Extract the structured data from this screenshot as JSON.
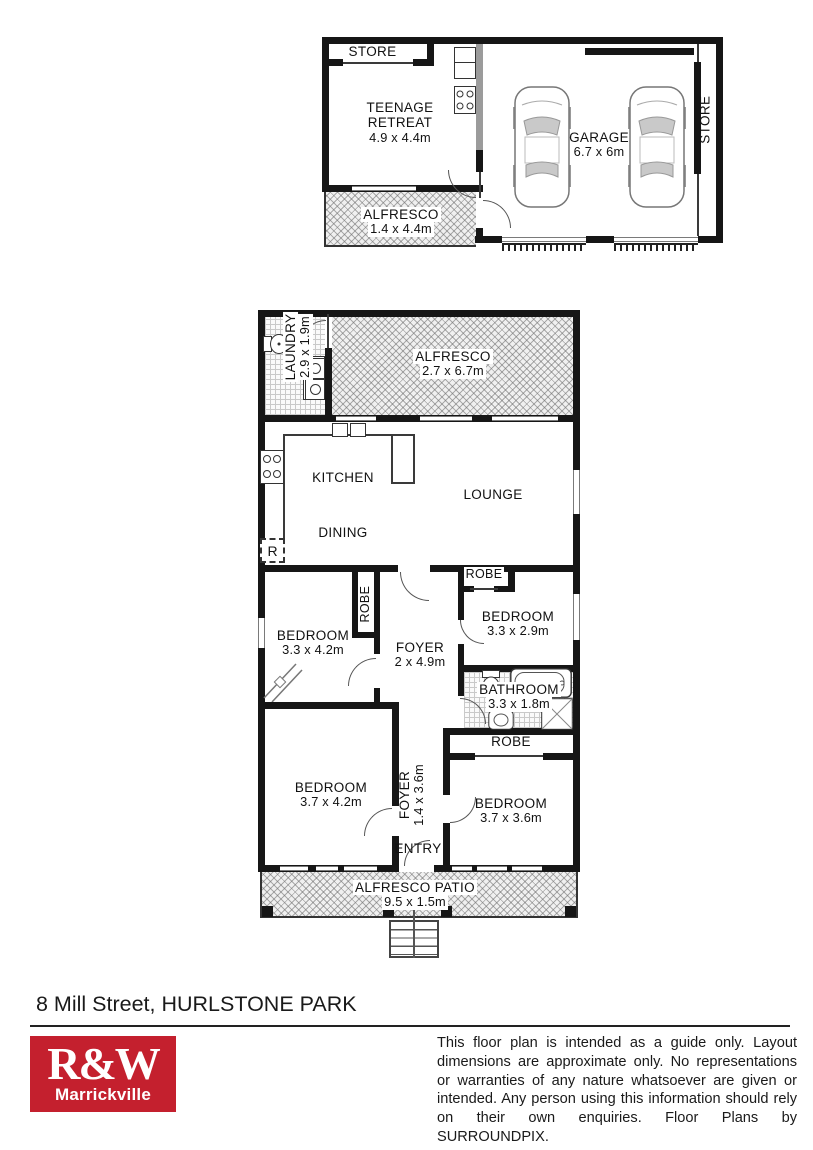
{
  "address": "8 Mill Street, HURLSTONE PARK",
  "logo": {
    "brand": "R&W",
    "office": "Marrickville",
    "color": "#c4202e"
  },
  "disclaimer": "This floor plan is intended as a guide only. Layout dimensions are approximate only. No representations or warranties of any nature whatsoever are given or intended. Any person using this information should rely on their own enquiries. Floor Plans by SURROUNDPIX.",
  "outbuilding": {
    "store_top": {
      "name": "STORE"
    },
    "teenage_retreat": {
      "name": "TEENAGE RETREAT",
      "dims": "4.9 x 4.4m"
    },
    "garage": {
      "name": "GARAGE",
      "dims": "6.7 x 6m"
    },
    "store_side": {
      "name": "STORE"
    },
    "alfresco": {
      "name": "ALFRESCO",
      "dims": "1.4 x 4.4m"
    }
  },
  "house": {
    "laundry": {
      "name": "LAUNDRY",
      "dims": "2.9 x 1.9m"
    },
    "alfresco": {
      "name": "ALFRESCO",
      "dims": "2.7 x 6.7m"
    },
    "kitchen": {
      "name": "KITCHEN"
    },
    "lounge": {
      "name": "LOUNGE"
    },
    "dining": {
      "name": "DINING"
    },
    "fridge": {
      "name": "R"
    },
    "robe_bed1": {
      "name": "ROBE"
    },
    "robe_bed2": {
      "name": "ROBE"
    },
    "robe_bed4": {
      "name": "ROBE"
    },
    "bedroom1": {
      "name": "BEDROOM",
      "dims": "3.3 x 4.2m"
    },
    "bedroom2": {
      "name": "BEDROOM",
      "dims": "3.3 x 2.9m"
    },
    "foyer": {
      "name": "FOYER",
      "dims": "2 x 4.9m"
    },
    "bathroom": {
      "name": "BATHROOM",
      "dims": "3.3 x 1.8m"
    },
    "bedroom3": {
      "name": "BEDROOM",
      "dims": "3.7 x 4.2m"
    },
    "foyer2": {
      "name": "FOYER",
      "dims": "1.4 x 3.6m"
    },
    "entry": {
      "name": "ENTRY"
    },
    "bedroom4": {
      "name": "BEDROOM",
      "dims": "3.7 x 3.6m"
    },
    "patio": {
      "name": "ALFRESCO PATIO",
      "dims": "9.5 x 1.5m"
    }
  }
}
